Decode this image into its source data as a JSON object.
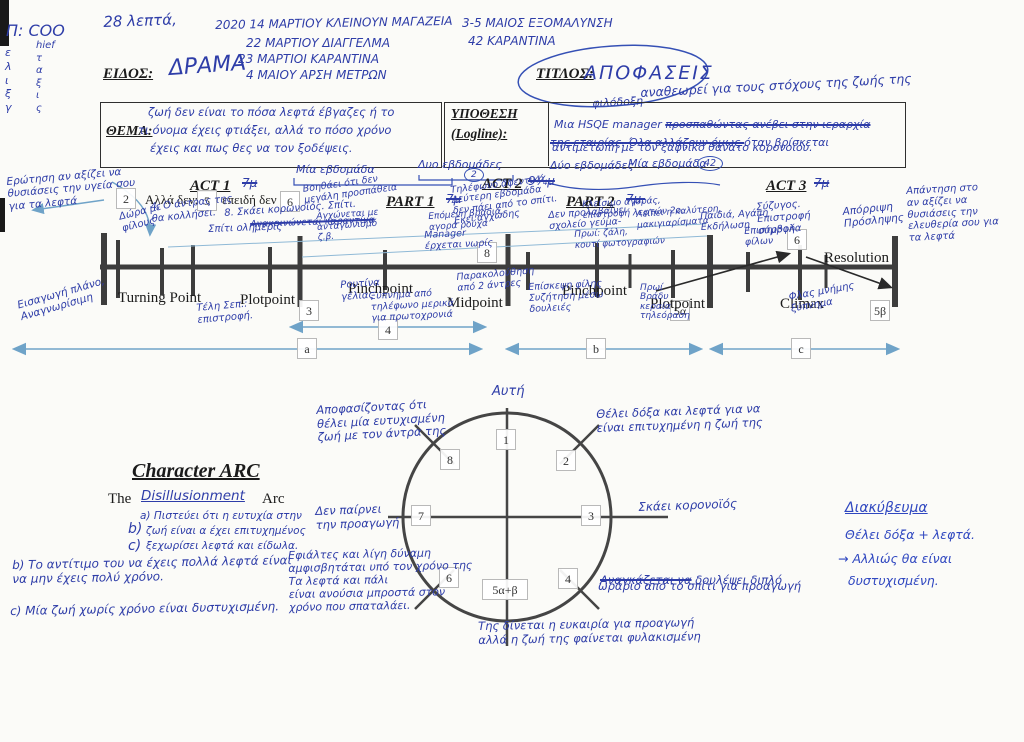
{
  "header": {
    "duration": "28 λεπτά,",
    "margin_code": "Π: COO",
    "margin_col1": "ε\nλ\nι\nξ\nγ",
    "margin_col2": "hief\nτ\nα\nξ\nι\nς",
    "dates": [
      {
        "text": "2020  14 ΜΑΡΤΙΟΥ ΚΛΕΙΝΟΥΝ ΜΑΓΑΖΕΙΑ"
      },
      {
        "text": "22 ΜΑΡΤΙΟΥ ΔΙΑΓΓΕΛΜΑ"
      },
      {
        "text": "23 ΜΑΡΤΙΟΙ ΚΑΡΑΝΤΙΝΑ"
      },
      {
        "text": "4 ΜΑΙΟΥ ΑΡΣΗ ΜΕΤΡΩΝ"
      }
    ],
    "right_note_1": "3-5 ΜΑΙΟΣ ΕΞΟΜΑΛΥΝΣΗ",
    "right_note_2": "42 ΚΑΡΑΝΤΙΝΑ",
    "eidos_label": "ΕΙΔΟΣ:",
    "eidos_value": "ΔΡΑΜΑ",
    "titlos_label": "ΤΙΤΛΟΣ:",
    "titlos_value": "ΑΠΟΦΑΣΕΙΣ",
    "titlos_sub": "φιλόδοξη",
    "titlos_note": "αναθεωρεί για τους στόχους της ζωής της"
  },
  "thema": {
    "label": "ΘΕΜΑ:",
    "l1": "ζωή δεν είναι το πόσα λεφτά έβγαζες ή το",
    "l2": "τι όνομα έχεις φτιάξει, αλλά το πόσο χρόνο",
    "l3": "έχεις και πως θες να τον ξοδέψεις."
  },
  "logline": {
    "label1": "ΥΠΟΘΕΣΗ",
    "label2": "(Logline):",
    "l1a": "Μια HSQE manager ",
    "l1b": "προσπαθώντας ανέβει στην ιεραρχία",
    "l2a": "της εταιρίας. Όλα αλλάζουν όμως ",
    "l2b": "όταν βρίσκεται",
    "l3": "αντιμέτωπη με τον ξαφνικό θάνατο κορονοϊού.",
    "weeks_above_1": "Μία εβδομάδα",
    "weeks_above_2": "Δυο εβδομάδες",
    "badge_above": "2",
    "weeks_below_1": "Δύο εβδομάδες",
    "weeks_below_2": "Μία εβδομάδα",
    "badge_below": "42"
  },
  "timeline": {
    "act1": "ACT 1",
    "act1_t": "7μ",
    "part1": "PART 1",
    "part1_t": "7μ",
    "act2": "ACT 2",
    "act2_t": "9¼μ",
    "part2": "PART 2",
    "part2_t": "7μ.",
    "act3": "ACT 3",
    "act3_t": "7μ",
    "inline1": "Αλλά δεν:",
    "inline2": "επειδή δεν",
    "points": {
      "tp": "Turning Point",
      "pp1": "Plotpoint",
      "pc1": "Pinchpoint",
      "mid": "Midpoint",
      "pc2": "Pinchpoint",
      "pp2": "Plotpoint",
      "cl": "Climax",
      "res": "Resolution"
    },
    "boxes": {
      "b2": "2",
      "b5": "5",
      "b6": "6",
      "b8": "8",
      "b3": "3",
      "b5a": "5α",
      "b5b": "5β",
      "b6r": "6",
      "b4": "4",
      "ba": "a",
      "bb": "b",
      "bc": "c"
    }
  },
  "annotations": [
    {
      "text": "Ερώτηση αν αξίζει να\nθυσιάσεις την υγεία σου\nγια τα λεφτά"
    },
    {
      "text": "Εισαγωγή πλάνο,\nΑναγνωρίσιμη"
    },
    {
      "text": "Δώρα με\nφίλους"
    },
    {
      "text": "4. Ο άντρας της\nθα κολλήσει."
    },
    {
      "text": "Σπίτι ολημερίς"
    },
    {
      "text": "8. Σκάει κορωνοϊός. Σπίτι."
    },
    {
      "text": "Ανακοινώνεται καραντίνα"
    },
    {
      "text": "Βοηθάει ότι δεν\nμεγάλη προσπάθεια"
    },
    {
      "text": "Αγχώνεται με\nανταγωνισμό\nζ.β."
    },
    {
      "text": "Manager\nέρχεται νωρίς"
    },
    {
      "text": "Τηλέφωνο αφεντικό\nΔεύτερη εβδομάδα\nδεν πάει από το σπίτι.\nΕκεί αγχώδης"
    },
    {
      "text": "Επόμενη βραδιά,\nαγορά ρούχα"
    },
    {
      "text": "Δεν προλαβαίνει\nσχολείο γεύμα-"
    },
    {
      "text": "Κλείσιμο αγοράς,\nεπιστροφή λεφτών 2ο."
    },
    {
      "text": "Λείπει η καλύτερη,\nμακιγιαρίσματα"
    },
    {
      "text": "Παιδιά, Αγάπη\nΕκδήλωση"
    },
    {
      "text": "Πρωί: ζάλη,\nκουτί φωτογραφιών"
    },
    {
      "text": "Επίσκεψη φίλης\nΣυζήτηση μέσω\nδουλειές"
    },
    {
      "text": "Ρουτίνα\nγέλιας"
    },
    {
      "text": "Ξύπνημα από\nτηλέφωνο μερικά\nγια πρωτοχρονιά"
    },
    {
      "text": "Παρακολούθηση\nαπό 2 άντρες"
    },
    {
      "text": "Τέλη Σεπ.:\nεπιστροφή."
    },
    {
      "text": "Πρωί\nΒράδυ\nκεραία\nτηλεόραση"
    },
    {
      "text": "Φλας μνήμης\nξύπνημα"
    },
    {
      "text": "Σύζυγος.\nΕπιστροφή\nσύμβολα"
    },
    {
      "text": "Απόρριψη\nΠρόσληψης"
    },
    {
      "text": "Απάντηση στο\nαν αξίζει να\nθυσιάσεις την\nελευθερία σου για\nτα λεφτά"
    },
    {
      "text": "Επιστροφή\nφίλων"
    }
  ],
  "arc": {
    "title": "Character ARC",
    "sub_pre": "The",
    "sub_hand": "Disillusionment",
    "sub_post": "Arc",
    "item_a": "a) Πιστεύει ότι η ευτυχία στην",
    "item_b": "ζωή είναι α έχει επιτυχημένος",
    "item_c": "ξεχωρίσει λεφτά και είδωλα.",
    "b_mark": "b)",
    "c_mark": "c)",
    "extra_b": "b) Το αντίτιμο του να έχεις πολλά λεφτά είναι\nνα μην έχεις πολύ χρόνο.",
    "extra_c": "c) Μία ζωή χωρίς χρόνο είναι δυστυχισμένη."
  },
  "circle": {
    "top_label": "Αυτή",
    "n1": "1",
    "n2": "2",
    "n3": "3",
    "n4": "4",
    "n5": "5α+β",
    "n6": "6",
    "n7": "7",
    "n8": "8"
  },
  "arc_notes": {
    "nw": "Αποφασίζοντας ότι\nθέλει μία ευτυχισμένη\nζωή με τον άντρα της",
    "ne": "Θέλει δόξα και λεφτά για να\nείναι επιτυχημένη η ζωή της",
    "e": "Σκάει κορονοϊός",
    "w": "Δεν παίρνει\nτην προαγωγή",
    "sw": "Εφιάλτες και λίγη δύναμη\nαμφισβητάται υπό τον χρόνο της\nΤα λεφτά και πάλι\nείναι ανούσια μπροστά στον\nχρόνο που σπαταλάει.",
    "s": "Της δίνεται η ευκαιρία για προαγωγή\nαλλά η ζωή της φαίνεται φυλακισμένη",
    "se_strike": "Αναγκάζεται να",
    "se_rest": "δουλέψει διπλό",
    "se_line2": "ωράριο από το σπίτι για προαγωγή"
  },
  "stakes": {
    "title": "Διακύβευμα",
    "l1": "Θέλει δόξα + λεφτά.",
    "l2": "→ Αλλιώς θα είναι",
    "l3": "δυστυχισμένη."
  },
  "colors": {
    "ink_blue": "#2e3da8",
    "print_black": "#1b1b1b",
    "line_dark": "#3d3d3d",
    "arrow_blue": "#6fa3c8"
  }
}
